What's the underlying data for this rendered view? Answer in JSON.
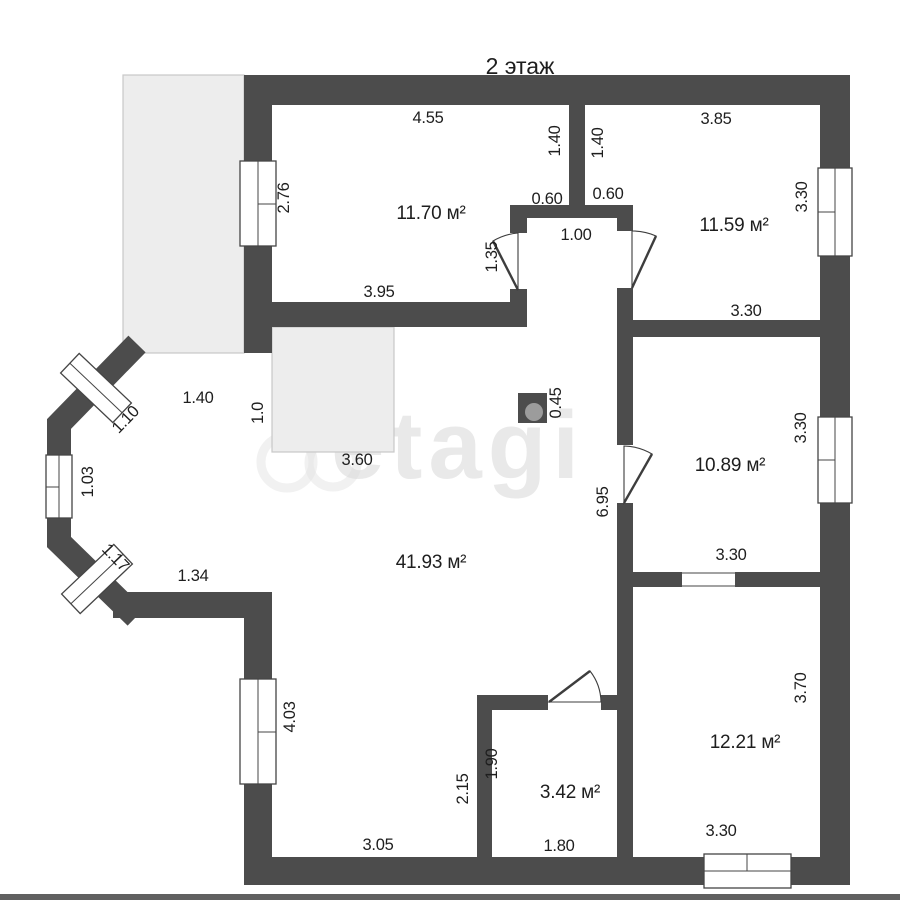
{
  "title": "2 этаж",
  "watermark": "etagi",
  "colors": {
    "wall": "#4c4c4c",
    "terrace_fill": "#ededed",
    "terrace_border": "#c8c8c8",
    "text": "#1e1e1e",
    "watermark": "#d8d8d8"
  },
  "rooms": [
    {
      "name": "bedroom-top-left",
      "area": "11.70 м²"
    },
    {
      "name": "bedroom-top-right",
      "area": "11.59 м²"
    },
    {
      "name": "room-middle-right",
      "area": "10.89 м²"
    },
    {
      "name": "living-room",
      "area": "41.93 м²"
    },
    {
      "name": "bathroom",
      "area": "3.42 м²"
    },
    {
      "name": "room-bottom-right",
      "area": "12.21 м²"
    }
  ],
  "labels": {
    "title": "2 этаж",
    "watermark": "etagi",
    "area_bedroom_left": "11.70 м²",
    "area_bedroom_right": "11.59 м²",
    "area_room_mid": "10.89 м²",
    "area_living": "41.93 м²",
    "area_bath": "3.42 м²",
    "area_room_bottom": "12.21 м²",
    "dim_top_left_room_width": "4.55",
    "dim_top_right_room_width": "3.85",
    "dim_divider_left": "1.40",
    "dim_divider_right": "1.40",
    "dim_window_left_top": "2.76",
    "dim_window_right_top": "3.30",
    "dim_stub_left": "0.60",
    "dim_stub_right": "0.60",
    "dim_vestibule_width": "1.00",
    "dim_door_left": "1.35",
    "dim_bedroom_left_bottom": "3.95",
    "dim_bedroom_right_bottom": "3.30",
    "dim_nook_width": "1.40",
    "dim_bay_window_top": "1.10",
    "dim_nook_height": "1.0",
    "dim_stairs": "3.60",
    "dim_chimney": "0.45",
    "dim_window_right_mid": "3.30",
    "dim_bay_window_left": "1.03",
    "dim_corridor_wall": "6.95",
    "dim_bay_window_bottom": "1.17",
    "dim_bay_bottom": "1.34",
    "dim_room_mid_bottom": "3.30",
    "dim_room_bottom_right_height": "3.70",
    "dim_window_left_bottom": "4.03",
    "dim_bath_exterior": "2.15",
    "dim_bath_height": "1.90",
    "dim_living_bottom": "3.05",
    "dim_bath_width": "1.80",
    "dim_room_bottom_width": "3.30"
  }
}
